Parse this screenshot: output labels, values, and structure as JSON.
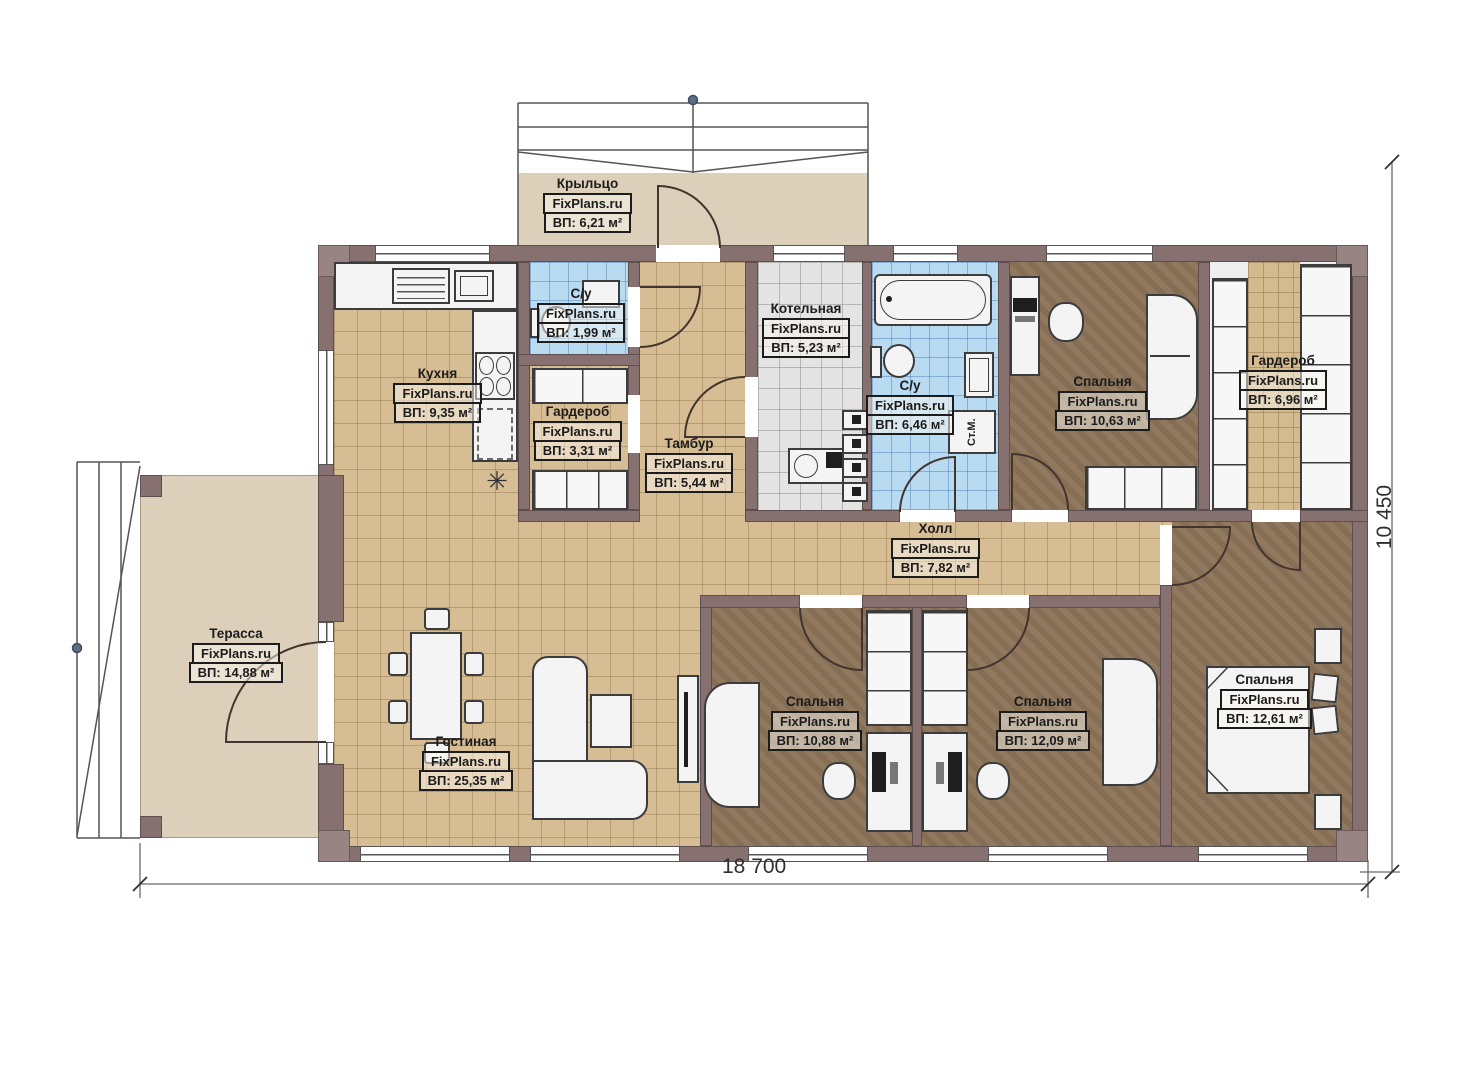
{
  "plan": {
    "watermark": "FixPlans.ru",
    "rooms": [
      {
        "key": "porch",
        "name": "Крыльцо",
        "area": "ВП: 6,21 м²"
      },
      {
        "key": "kitchen",
        "name": "Кухня",
        "area": "ВП: 9,35 м²"
      },
      {
        "key": "wc_small",
        "name": "С/у",
        "area": "ВП: 1,99 м²"
      },
      {
        "key": "wardrobe_small",
        "name": "Гардероб",
        "area": "ВП: 3,31 м²"
      },
      {
        "key": "vestibule",
        "name": "Тамбур",
        "area": "ВП: 5,44 м²"
      },
      {
        "key": "boiler_room",
        "name": "Котельная",
        "area": "ВП: 5,23 м²"
      },
      {
        "key": "bathroom",
        "name": "С/у",
        "area": "ВП: 6,46 м²"
      },
      {
        "key": "bedroom_top",
        "name": "Спальня",
        "area": "ВП: 10,63 м²"
      },
      {
        "key": "wardrobe_main",
        "name": "Гардероб",
        "area": "ВП: 6,96 м²"
      },
      {
        "key": "hall",
        "name": "Холл",
        "area": "ВП: 7,82 м²"
      },
      {
        "key": "terrace",
        "name": "Терасса",
        "area": "ВП: 14,88 м²"
      },
      {
        "key": "living_room",
        "name": "Гостиная",
        "area": "ВП: 25,35 м²"
      },
      {
        "key": "bedroom_left",
        "name": "Спальня",
        "area": "ВП: 10,88 м²"
      },
      {
        "key": "bedroom_middle",
        "name": "Спальня",
        "area": "ВП: 12,09 м²"
      },
      {
        "key": "bedroom_right",
        "name": "Спальня",
        "area": "ВП: 12,61 м²"
      }
    ],
    "fixtures": {
      "washing_machine": "Ст.М."
    },
    "icons": {
      "snowflake": "✳"
    },
    "dimensions": {
      "width_total": "18 700",
      "height_total": "10 450"
    },
    "colors": {
      "wall": "#867070",
      "tile_floor": "#d6bd93",
      "wood_floor": "#8c7458",
      "bath_tile": "#b9dbf2",
      "boiler_tile": "#e4e4e4",
      "outdoor_floor": "#ddd0ba"
    }
  }
}
